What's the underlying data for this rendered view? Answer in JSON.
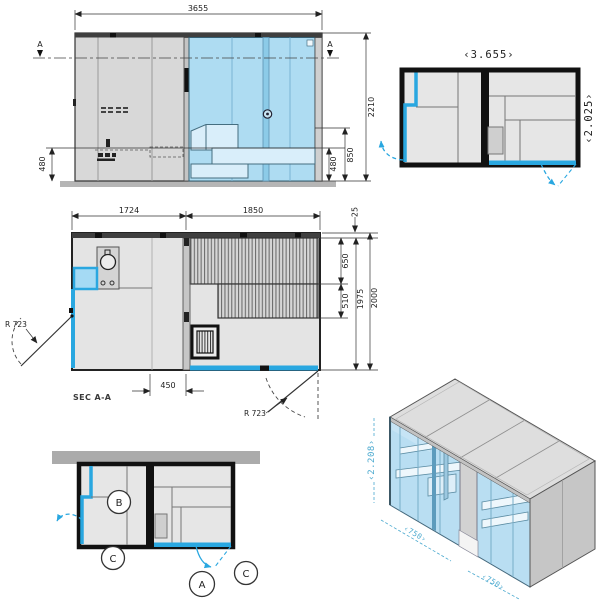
{
  "colors": {
    "glass_light": "#aedcf2",
    "glass_accent": "#29a7e0",
    "panel_gray": "#d8d8d8",
    "wall_black": "#151515",
    "band_gray": "#ababab"
  },
  "elevation": {
    "dim_width": "3655",
    "dim_height": "2210",
    "dim_bench_back": "850",
    "dim_bench_left": "480",
    "dim_bench_right": "480",
    "section_left": "A",
    "section_right": "A"
  },
  "plan_overview": {
    "dim_width": "‹3.655›",
    "dim_depth": "‹2.025›"
  },
  "section_plan": {
    "title": "SEC A-A",
    "dim_module_left": "1724",
    "dim_module_right": "1850",
    "dim_wall": "25",
    "dim_bench_deep": "650",
    "dim_bench_low": "510",
    "dim_inner_depth": "1975",
    "dim_outer_depth": "2000",
    "dim_door_offset": "450",
    "radius_door_left": "R 723",
    "radius_door_right": "R 723"
  },
  "detail_plan": {
    "label_a": "A",
    "label_b": "B",
    "label_c_left": "C",
    "label_c_right": "C"
  },
  "isometric": {
    "dim_height": "‹2.208›",
    "dim_front_left": "‹750›",
    "dim_front_right": "‹750›"
  }
}
